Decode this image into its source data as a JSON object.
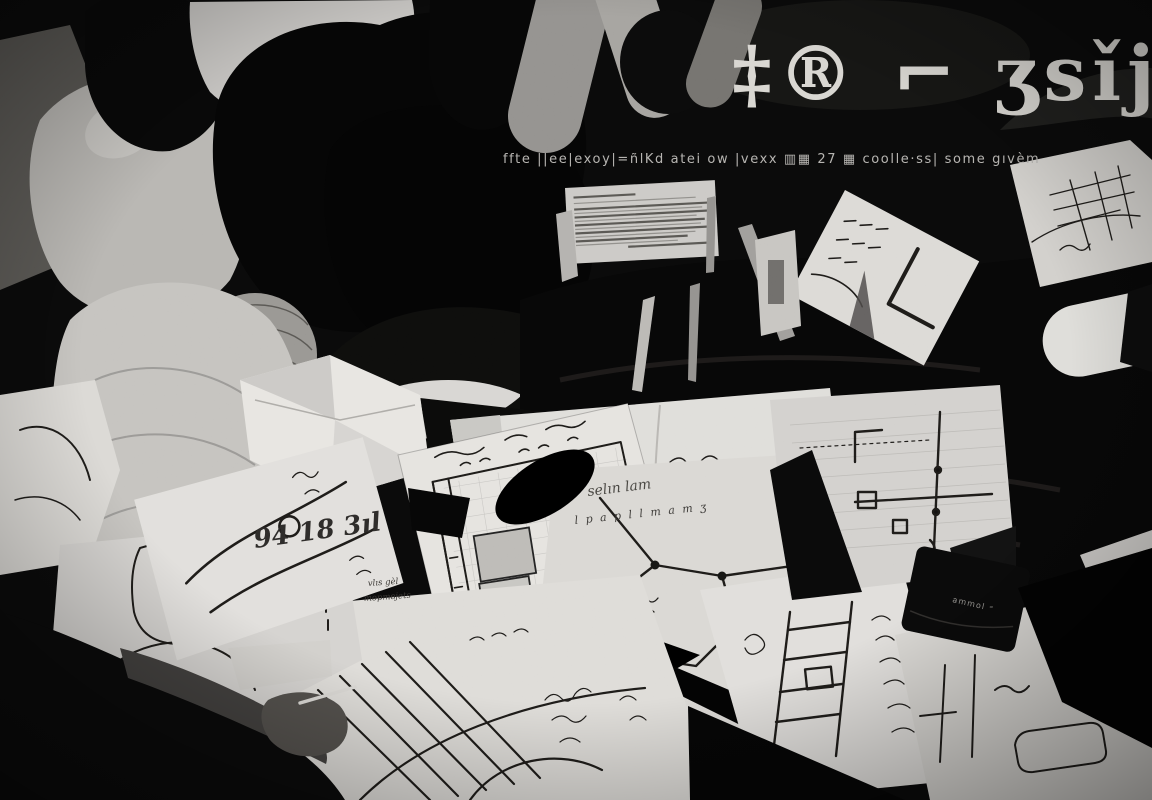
{
  "image": {
    "type": "black-and-white photograph",
    "description": "People crouched together over a dark floor strewn with papers bearing hand-drawn maps, a gridded floor plan, network and circuit diagrams; a hand with a pen reaches in from the lower left; large distorted calligraphic glyphs and a line of garbled small print overlay the dark upper-right area.",
    "palette": {
      "background": "#050505",
      "paper": "#dedcd8",
      "ink": "#1c1a18",
      "skin_gray": "#93918d",
      "overlay_text": "#d6d4ce"
    }
  },
  "overlay_text": {
    "title_glyphs": "‡® ⌐ ʒsǐj",
    "caption_glyphs": "ffte ||ee|exoy|=ñlKd atei ow |vexx ▥▦ 27 ▦ coolle·ss| some gıvèm"
  },
  "handwriting": {
    "left_paper_note": "94 18 3ıl",
    "center_sheet_cursive": "selın lam",
    "center_sheet_row": "l p a p l l m a m ʒ",
    "map_label_1": "vlıs gèl",
    "map_label_2": "mортвjets",
    "book_label": "ammol ⁼"
  }
}
